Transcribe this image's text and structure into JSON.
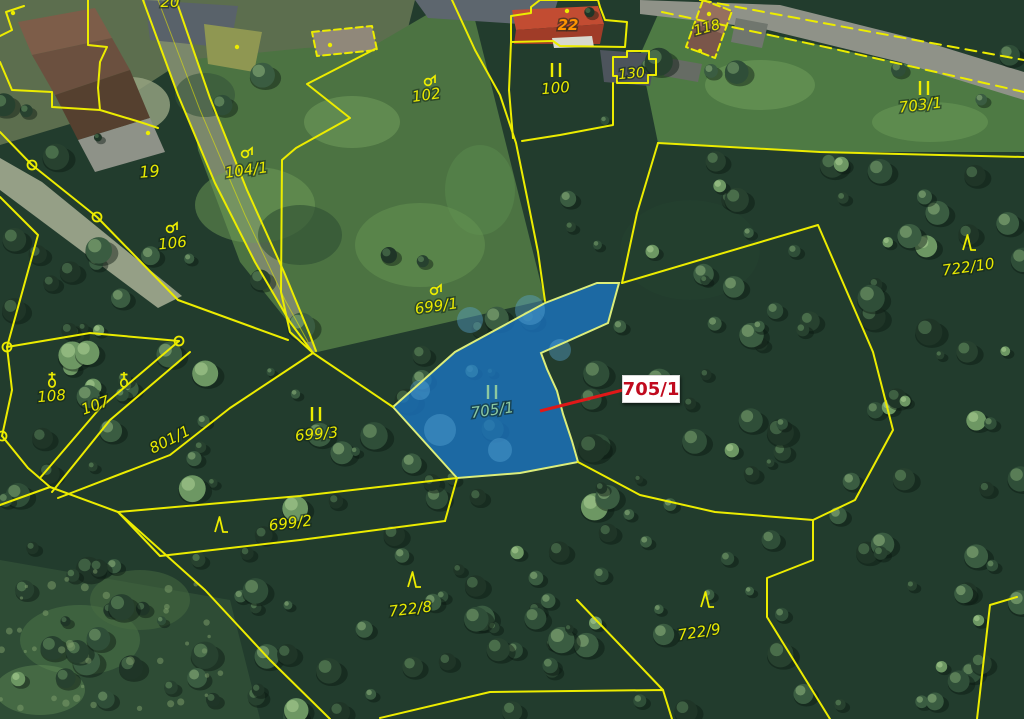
{
  "map": {
    "colors": {
      "boundary": "#ecec00",
      "label": "#e9e900",
      "house_number": "#ff9500",
      "highlight_fill": "#1b76c4",
      "highlight_stroke": "#dced7a",
      "highlight_label": "#8cc8a0",
      "callout_text": "#c00a1e",
      "callout_line": "#e01818",
      "callout_bg": "#ffffff",
      "node_ring": "#ecec00"
    },
    "labels": [
      {
        "text": "19",
        "x": 150,
        "y": 177,
        "rot": -5,
        "size": 16
      },
      {
        "text": "20",
        "x": 170,
        "y": 7,
        "rot": 0,
        "size": 15
      },
      {
        "text": "22",
        "x": 568,
        "y": 30,
        "rot": 0,
        "size": 15,
        "color": "#ff9500",
        "bold": true
      },
      {
        "text": "100",
        "x": 556,
        "y": 93,
        "rot": -5,
        "size": 15
      },
      {
        "text": "102",
        "x": 427,
        "y": 100,
        "rot": -8,
        "size": 15
      },
      {
        "text": "104/1",
        "x": 247,
        "y": 175,
        "rot": -8,
        "size": 15
      },
      {
        "text": "106",
        "x": 173,
        "y": 248,
        "rot": -6,
        "size": 15
      },
      {
        "text": "107",
        "x": 97,
        "y": 410,
        "rot": -20,
        "size": 15
      },
      {
        "text": "108",
        "x": 52,
        "y": 401,
        "rot": -5,
        "size": 15
      },
      {
        "text": "118",
        "x": 708,
        "y": 32,
        "rot": -15,
        "size": 14
      },
      {
        "text": "130",
        "x": 632,
        "y": 78,
        "rot": -5,
        "size": 14
      },
      {
        "text": "703/1",
        "x": 921,
        "y": 110,
        "rot": -7,
        "size": 15
      },
      {
        "text": "699/1",
        "x": 437,
        "y": 311,
        "rot": -8,
        "size": 15
      },
      {
        "text": "699/2",
        "x": 291,
        "y": 528,
        "rot": -7,
        "size": 15
      },
      {
        "text": "699/3",
        "x": 317,
        "y": 439,
        "rot": -5,
        "size": 15
      },
      {
        "text": "722/8",
        "x": 411,
        "y": 614,
        "rot": -7,
        "size": 15
      },
      {
        "text": "722/9",
        "x": 700,
        "y": 637,
        "rot": -9,
        "size": 15
      },
      {
        "text": "722/10",
        "x": 969,
        "y": 272,
        "rot": -8,
        "size": 15
      },
      {
        "text": "801/1",
        "x": 172,
        "y": 444,
        "rot": -27,
        "size": 15
      },
      {
        "text": "705/1",
        "x": 493,
        "y": 415,
        "rot": -8,
        "size": 15,
        "color": "#8cc8a0"
      }
    ],
    "symbols": [
      {
        "type": "meadow",
        "x": 556,
        "y": 70
      },
      {
        "type": "meadow",
        "x": 924,
        "y": 88
      },
      {
        "type": "meadow",
        "x": 316,
        "y": 414
      },
      {
        "type": "meadow",
        "x": 492,
        "y": 392,
        "color": "#8cc8a0"
      },
      {
        "type": "orchard",
        "x": 428,
        "y": 81
      },
      {
        "type": "orchard",
        "x": 245,
        "y": 153
      },
      {
        "type": "orchard",
        "x": 170,
        "y": 228
      },
      {
        "type": "orchard",
        "x": 434,
        "y": 290
      },
      {
        "type": "garden",
        "x": 52,
        "y": 381
      },
      {
        "type": "garden",
        "x": 124,
        "y": 381
      },
      {
        "type": "forest",
        "x": 220,
        "y": 524
      },
      {
        "type": "forest",
        "x": 413,
        "y": 579
      },
      {
        "type": "forest",
        "x": 706,
        "y": 599
      },
      {
        "type": "forest",
        "x": 968,
        "y": 242
      },
      {
        "type": "dot",
        "x": 148,
        "y": 133
      },
      {
        "type": "dot",
        "x": 13,
        "y": 13
      },
      {
        "type": "dot",
        "x": 237,
        "y": 47
      },
      {
        "type": "dot",
        "x": 330,
        "y": 45
      },
      {
        "type": "dot",
        "x": 567,
        "y": 11
      },
      {
        "type": "dot",
        "x": 709,
        "y": 14
      },
      {
        "type": "dot",
        "x": 700,
        "y": 51
      }
    ],
    "nodes": [
      [
        32,
        165
      ],
      [
        97,
        217
      ],
      [
        7,
        347
      ],
      [
        2,
        436
      ],
      [
        179,
        341
      ]
    ],
    "boundaries": [
      {
        "points": [
          [
            143,
            0
          ],
          [
            178,
            95
          ],
          [
            215,
            183
          ],
          [
            255,
            262
          ],
          [
            290,
            322
          ],
          [
            313,
            353
          ]
        ]
      },
      {
        "points": [
          [
            176,
            0
          ],
          [
            210,
            98
          ],
          [
            247,
            190
          ],
          [
            284,
            272
          ],
          [
            310,
            335
          ],
          [
            316,
            351
          ]
        ]
      },
      {
        "points": [
          [
            158,
            0
          ],
          [
            200,
            110
          ],
          [
            245,
            215
          ],
          [
            285,
            300
          ],
          [
            308,
            342
          ]
        ],
        "width": 1,
        "opacity": 0.55
      },
      {
        "points": [
          [
            88,
            0
          ],
          [
            88,
            45
          ],
          [
            107,
            47
          ],
          [
            100,
            62
          ],
          [
            98,
            88
          ],
          [
            100,
            110
          ],
          [
            52,
            107
          ],
          [
            52,
            92
          ],
          [
            12,
            90
          ],
          [
            0,
            62
          ]
        ]
      },
      {
        "points": [
          [
            0,
            36
          ],
          [
            12,
            30
          ],
          [
            6,
            12
          ],
          [
            24,
            6
          ]
        ]
      },
      {
        "points": [
          [
            100,
            110
          ],
          [
            140,
            122
          ],
          [
            158,
            128
          ]
        ]
      },
      {
        "points": [
          [
            375,
            49
          ],
          [
            307,
            84
          ],
          [
            350,
            118
          ],
          [
            296,
            148
          ],
          [
            282,
            160
          ],
          [
            281,
            292
          ],
          [
            290,
            332
          ],
          [
            313,
            353
          ]
        ]
      },
      {
        "points": [
          [
            452,
            0
          ],
          [
            475,
            50
          ],
          [
            500,
            95
          ],
          [
            516,
            143
          ],
          [
            527,
            197
          ],
          [
            538,
            252
          ],
          [
            545,
            301
          ]
        ]
      },
      {
        "points": [
          [
            613,
            100
          ],
          [
            613,
            125
          ],
          [
            560,
            135
          ],
          [
            522,
            141
          ]
        ]
      },
      {
        "points": [
          [
            613,
            100
          ],
          [
            613,
            83
          ]
        ]
      },
      {
        "points": [
          [
            511,
            42
          ],
          [
            509,
            90
          ],
          [
            513,
            138
          ]
        ]
      },
      {
        "points": [
          [
            313,
            353
          ],
          [
            393,
            407
          ]
        ]
      },
      {
        "points": [
          [
            0,
            132
          ],
          [
            32,
            165
          ],
          [
            97,
            217
          ],
          [
            178,
            300
          ],
          [
            288,
            340
          ]
        ]
      },
      {
        "points": [
          [
            0,
            197
          ],
          [
            38,
            235
          ],
          [
            7,
            347
          ]
        ]
      },
      {
        "points": [
          [
            7,
            347
          ],
          [
            90,
            333
          ],
          [
            179,
            341
          ]
        ]
      },
      {
        "points": [
          [
            7,
            347
          ],
          [
            12,
            390
          ],
          [
            2,
            436
          ]
        ]
      },
      {
        "points": [
          [
            2,
            436
          ],
          [
            28,
            468
          ],
          [
            50,
            487
          ]
        ]
      },
      {
        "points": [
          [
            179,
            341
          ],
          [
            100,
            408
          ],
          [
            40,
            478
          ]
        ]
      },
      {
        "points": [
          [
            190,
            352
          ],
          [
            110,
            420
          ],
          [
            52,
            492
          ]
        ]
      },
      {
        "points": [
          [
            313,
            353
          ],
          [
            230,
            408
          ],
          [
            170,
            455
          ],
          [
            58,
            498
          ]
        ]
      },
      {
        "points": [
          [
            50,
            487
          ],
          [
            0,
            505
          ]
        ]
      },
      {
        "points": [
          [
            50,
            487
          ],
          [
            118,
            512
          ]
        ]
      },
      {
        "points": [
          [
            118,
            512
          ],
          [
            300,
            496
          ],
          [
            457,
            478
          ]
        ]
      },
      {
        "points": [
          [
            457,
            478
          ],
          [
            445,
            521
          ]
        ]
      },
      {
        "points": [
          [
            445,
            521
          ],
          [
            300,
            540
          ],
          [
            160,
            556
          ],
          [
            118,
            512
          ]
        ]
      },
      {
        "points": [
          [
            118,
            512
          ],
          [
            205,
            590
          ],
          [
            270,
            660
          ],
          [
            330,
            719
          ]
        ]
      },
      {
        "points": [
          [
            578,
            462
          ],
          [
            640,
            495
          ],
          [
            715,
            512
          ],
          [
            813,
            520
          ],
          [
            813,
            560
          ],
          [
            767,
            578
          ],
          [
            767,
            617
          ],
          [
            830,
            719
          ]
        ]
      },
      {
        "points": [
          [
            622,
            283
          ],
          [
            818,
            225
          ],
          [
            873,
            352
          ],
          [
            893,
            430
          ],
          [
            855,
            500
          ],
          [
            813,
            520
          ]
        ]
      },
      {
        "points": [
          [
            658,
            143
          ],
          [
            637,
            213
          ],
          [
            622,
            283
          ]
        ]
      },
      {
        "points": [
          [
            658,
            143
          ],
          [
            820,
            152
          ],
          [
            1024,
            157
          ]
        ]
      },
      {
        "points": [
          [
            380,
            718
          ],
          [
            490,
            692
          ],
          [
            663,
            690
          ],
          [
            672,
            719
          ]
        ]
      },
      {
        "points": [
          [
            577,
            600
          ],
          [
            663,
            690
          ]
        ]
      },
      {
        "points": [
          [
            1017,
            597
          ],
          [
            990,
            605
          ],
          [
            977,
            719
          ]
        ]
      },
      {
        "points": [
          [
            700,
            0
          ],
          [
            850,
            28
          ],
          [
            1024,
            60
          ]
        ],
        "dash": "11 7"
      },
      {
        "points": [
          [
            662,
            12
          ],
          [
            830,
            48
          ],
          [
            1024,
            92
          ]
        ],
        "dash": "11 7"
      },
      {
        "points": [
          [
            613,
            57
          ],
          [
            627,
            57
          ],
          [
            627,
            51
          ],
          [
            649,
            51
          ],
          [
            649,
            59
          ],
          [
            656,
            59
          ],
          [
            656,
            75
          ],
          [
            648,
            75
          ],
          [
            648,
            83
          ],
          [
            617,
            83
          ],
          [
            617,
            76
          ],
          [
            613,
            76
          ],
          [
            613,
            57
          ]
        ]
      },
      {
        "points": [
          [
            703,
            0
          ],
          [
            732,
            11
          ],
          [
            715,
            58
          ],
          [
            686,
            47
          ],
          [
            703,
            0
          ]
        ],
        "dash": "7 4"
      },
      {
        "points": [
          [
            312,
            32
          ],
          [
            372,
            26
          ],
          [
            377,
            50
          ],
          [
            317,
            56
          ],
          [
            312,
            32
          ]
        ],
        "dash": "7 4"
      },
      {
        "points": [
          [
            511,
            42
          ],
          [
            511,
            16
          ],
          [
            531,
            13
          ],
          [
            531,
            7
          ],
          [
            540,
            0
          ],
          [
            598,
            0
          ],
          [
            600,
            7
          ],
          [
            605,
            20
          ],
          [
            627,
            22
          ],
          [
            625,
            47
          ],
          [
            560,
            46
          ],
          [
            553,
            41
          ],
          [
            511,
            42
          ]
        ]
      }
    ],
    "highlight": {
      "parcel": "705/1",
      "points": [
        [
          597,
          283
        ],
        [
          619,
          283
        ],
        [
          608,
          323
        ],
        [
          541,
          353
        ],
        [
          547,
          369
        ],
        [
          557,
          391
        ],
        [
          563,
          414
        ],
        [
          572,
          441
        ],
        [
          578,
          462
        ],
        [
          520,
          473
        ],
        [
          457,
          478
        ],
        [
          393,
          407
        ],
        [
          455,
          352
        ],
        [
          545,
          303
        ]
      ],
      "opacity": 0.78
    },
    "callout": {
      "text": "705/1",
      "box": {
        "x": 622,
        "y": 375,
        "w": 56,
        "h": 26
      },
      "line": [
        [
          540,
          411
        ],
        [
          623,
          390
        ]
      ]
    }
  }
}
